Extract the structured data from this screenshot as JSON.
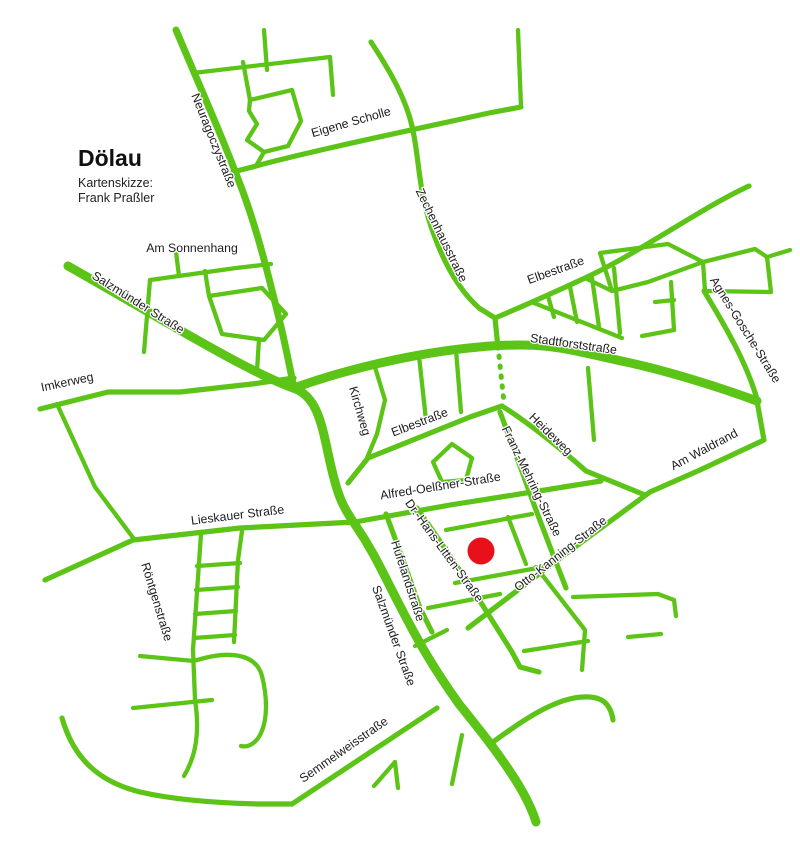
{
  "map": {
    "title": "Dölau",
    "subtitle_lines": [
      "Kartenskizze:",
      "Frank Praßler"
    ],
    "colors": {
      "road_green": "#5cc417",
      "label_text": "#1c1c1c",
      "background": "#ffffff",
      "marker_red": "#e8111a"
    },
    "marker": {
      "id": "location-marker",
      "x": 481,
      "y": 551,
      "radius": 13.5,
      "color": "#e8111a"
    },
    "street_labels": [
      {
        "id": "neuragoczystrasse",
        "text": "Neuragoczystraße",
        "x": 210,
        "y": 142,
        "rot": 68
      },
      {
        "id": "eigene-scholle",
        "text": "Eigene Scholle",
        "x": 352,
        "y": 126,
        "rot": -16
      },
      {
        "id": "zechenhausstrasse",
        "text": "Zechenhausstraße",
        "x": 438,
        "y": 237,
        "rot": 64
      },
      {
        "id": "am-sonnenhang",
        "text": "Am Sonnenhang",
        "x": 192,
        "y": 252,
        "rot": 0
      },
      {
        "id": "salzmuender-nw",
        "text": "Salzmünder Straße",
        "x": 136,
        "y": 306,
        "rot": 32
      },
      {
        "id": "elbestrasse-nord",
        "text": "Elbestraße",
        "x": 557,
        "y": 274,
        "rot": -20
      },
      {
        "id": "stadtforststrasse",
        "text": "Stadtforststraße",
        "x": 573,
        "y": 348,
        "rot": 8
      },
      {
        "id": "agnes-gosche-strasse",
        "text": "Agnes-Gosche-Straße",
        "x": 742,
        "y": 332,
        "rot": 58
      },
      {
        "id": "imkerweg",
        "text": "Imkerweg",
        "x": 68,
        "y": 386,
        "rot": -12
      },
      {
        "id": "kirchweg",
        "text": "Kirchweg",
        "x": 356,
        "y": 412,
        "rot": 74
      },
      {
        "id": "elbestrasse-mitte",
        "text": "Elbestraße",
        "x": 421,
        "y": 426,
        "rot": -21
      },
      {
        "id": "heideweg",
        "text": "Heideweg",
        "x": 548,
        "y": 437,
        "rot": 44
      },
      {
        "id": "am-waldrand",
        "text": "Am Waldrand",
        "x": 706,
        "y": 453,
        "rot": -28
      },
      {
        "id": "franz-mehring-strasse",
        "text": "Franz-Mehring-Straße",
        "x": 528,
        "y": 483,
        "rot": 64
      },
      {
        "id": "alfred-oelssner-strasse",
        "text": "Alfred-Oelßner-Straße",
        "x": 441,
        "y": 490,
        "rot": -9
      },
      {
        "id": "lieskauer-strasse",
        "text": "Lieskauer Straße",
        "x": 238,
        "y": 519,
        "rot": -7
      },
      {
        "id": "dr-hans-litten-strasse",
        "text": "Dr.-Hans-Litten-Straße",
        "x": 441,
        "y": 553,
        "rot": 54
      },
      {
        "id": "otto-kanning-strasse",
        "text": "Otto-Kanning-Straße",
        "x": 563,
        "y": 557,
        "rot": -38
      },
      {
        "id": "hufelandstrasse",
        "text": "Hufelandstraße",
        "x": 404,
        "y": 582,
        "rot": 72
      },
      {
        "id": "roentgenstrasse",
        "text": "Röntgenstraße",
        "x": 153,
        "y": 603,
        "rot": 73
      },
      {
        "id": "salzmuender-sued",
        "text": "Salzmünder Straße",
        "x": 390,
        "y": 637,
        "rot": 70
      },
      {
        "id": "semmelweisstrasse",
        "text": "Semmelweisstraße",
        "x": 346,
        "y": 753,
        "rot": -35
      }
    ]
  }
}
